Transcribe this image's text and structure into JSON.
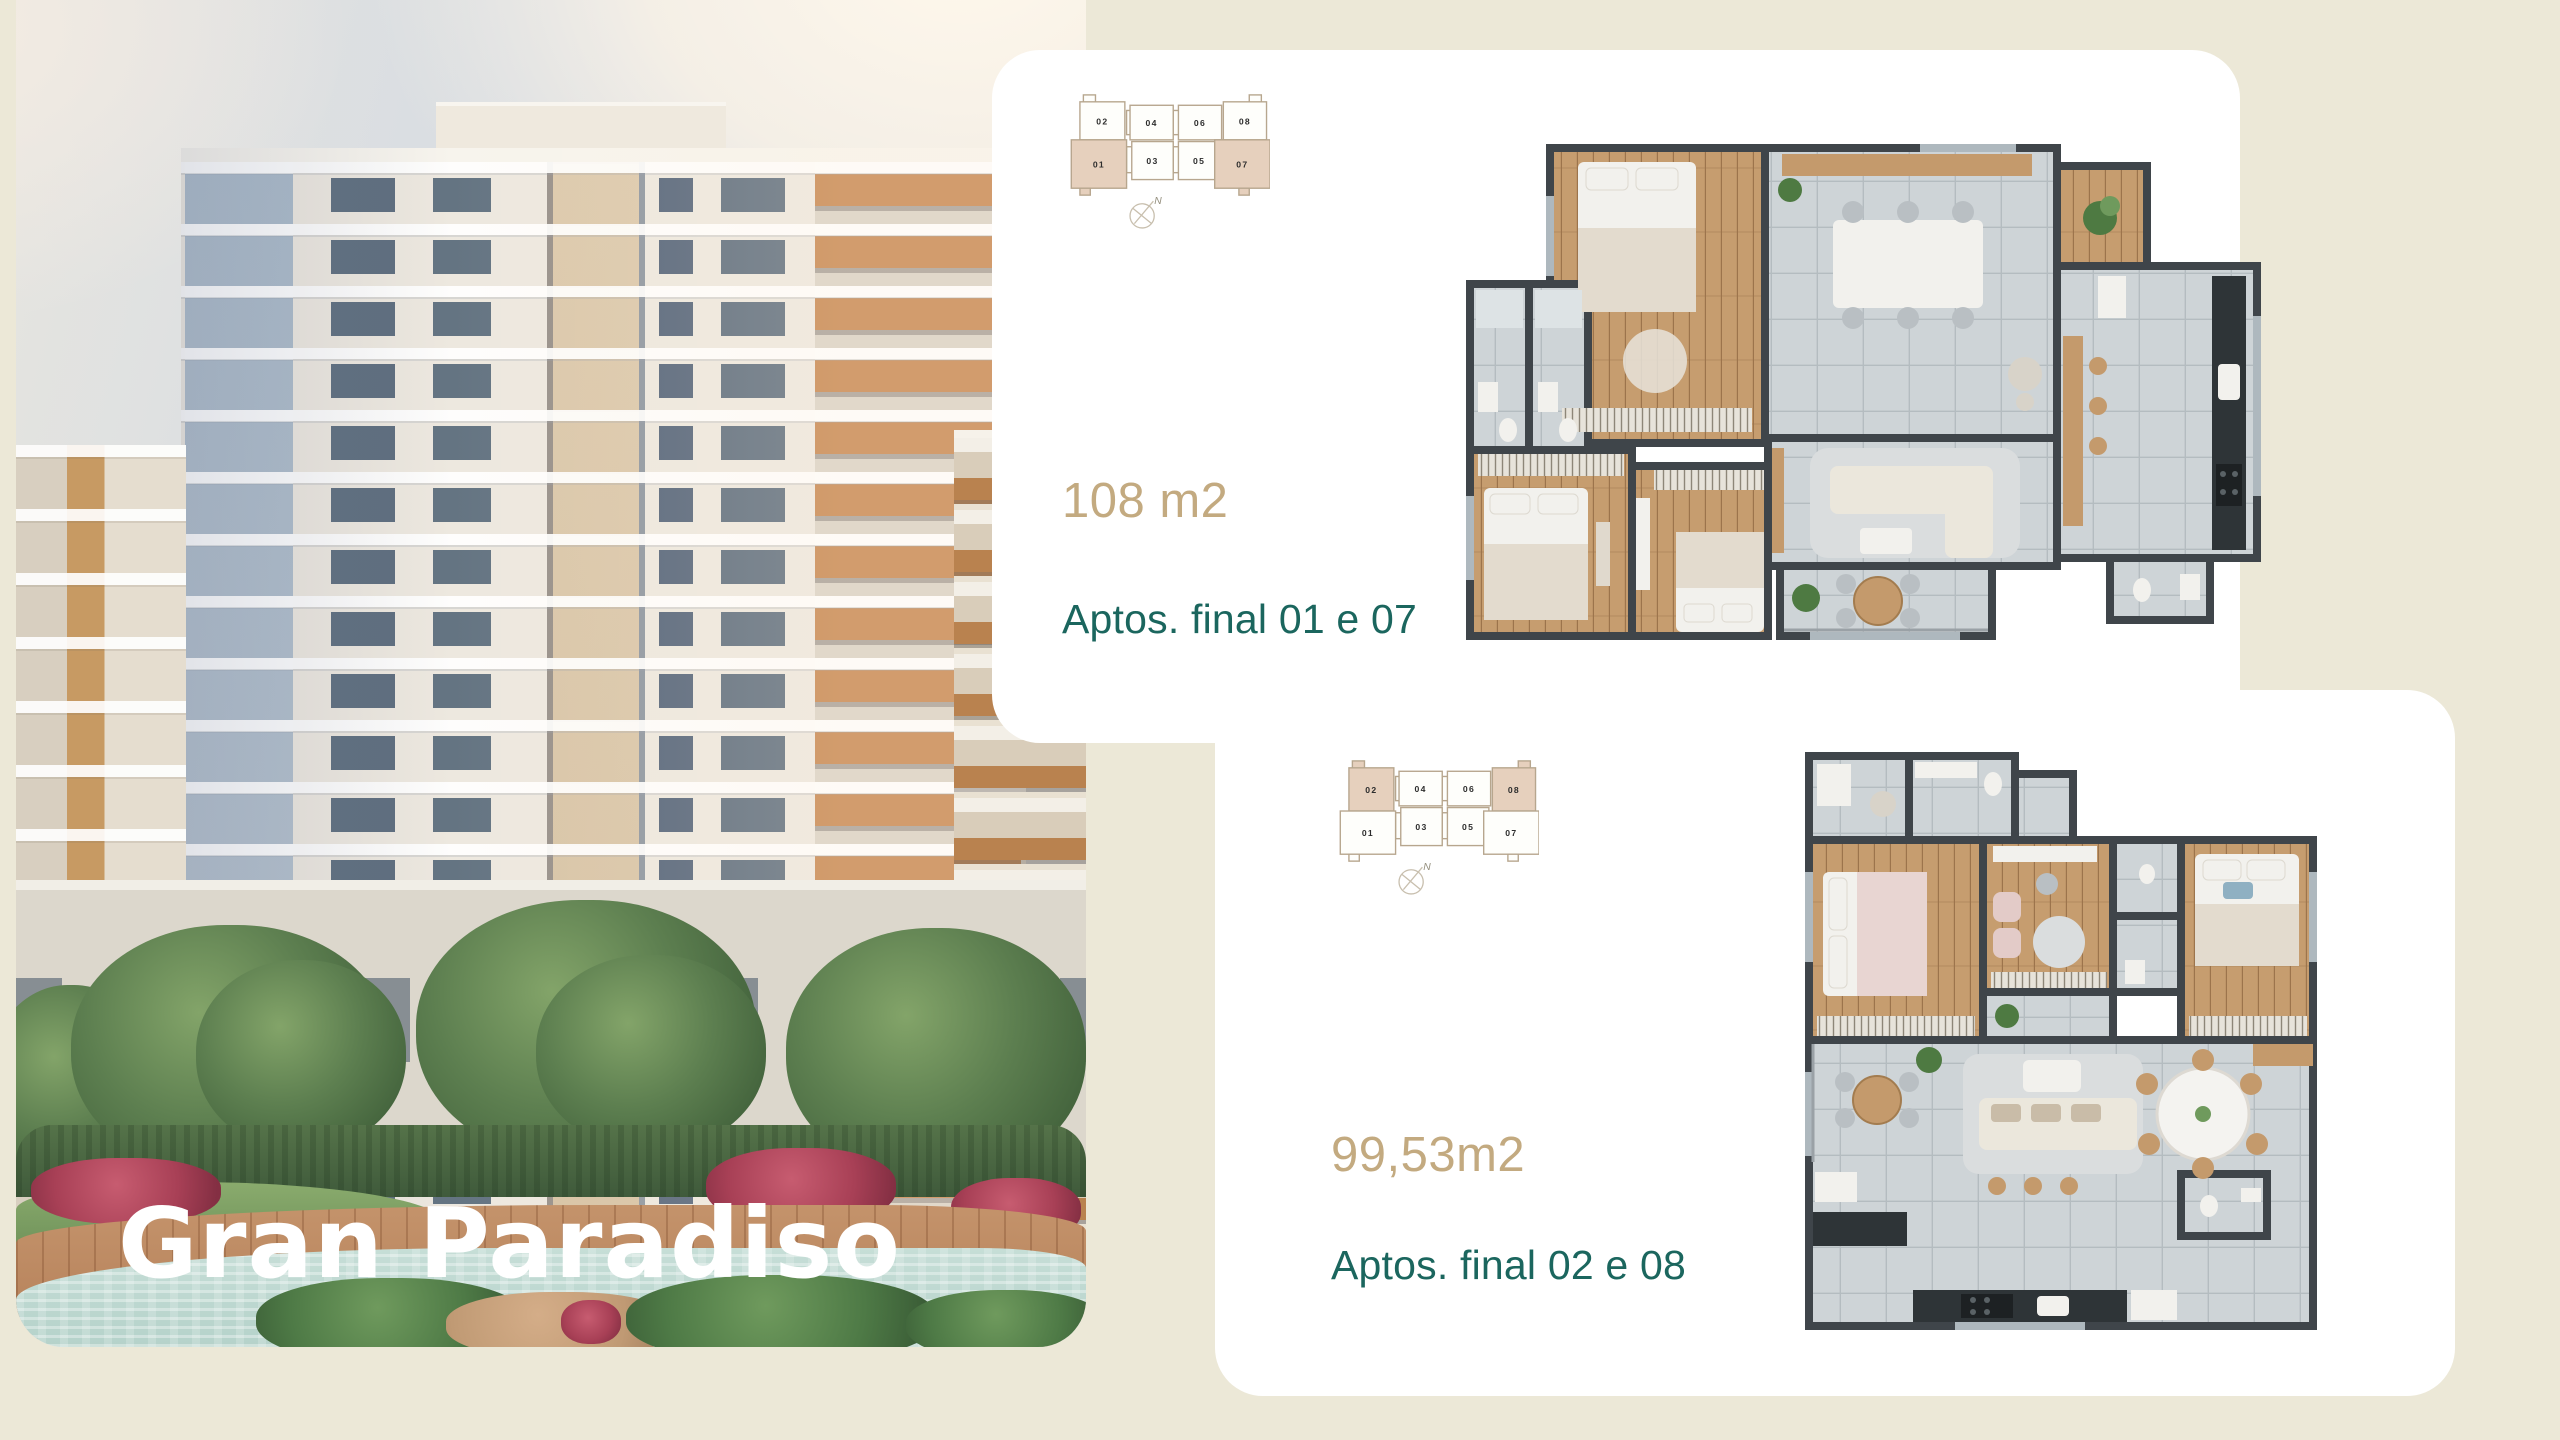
{
  "page": {
    "background_color": "#ECE8D7",
    "card_color": "#FFFFFF"
  },
  "photo_panel": {
    "title": "Gran Paradiso"
  },
  "cards": [
    {
      "area": "108 m2",
      "apartments": "Aptos. final 01 e 07",
      "key_plan": {
        "row_top": [
          "02",
          "04",
          "06",
          "08"
        ],
        "row_bottom": [
          "01",
          "03",
          "05",
          "07"
        ],
        "highlighted_units": [
          "01",
          "07"
        ],
        "north_label": "N"
      }
    },
    {
      "area": "99,53m2",
      "apartments": "Aptos. final 02 e 08",
      "key_plan": {
        "row_top": [
          "02",
          "04",
          "06",
          "08"
        ],
        "row_bottom": [
          "01",
          "03",
          "05",
          "07"
        ],
        "highlighted_units": [
          "02",
          "08"
        ],
        "north_label": "N"
      }
    }
  ],
  "colors": {
    "accent_tan": "#C3AA80",
    "accent_teal": "#1B665E",
    "keyplan_outline": "#B7A68E",
    "keyplan_highlight": "#E6D0BD",
    "plan_wall": "#3F454A",
    "plan_tile": "#CED4D7",
    "plan_wood": "#C69D6F"
  }
}
